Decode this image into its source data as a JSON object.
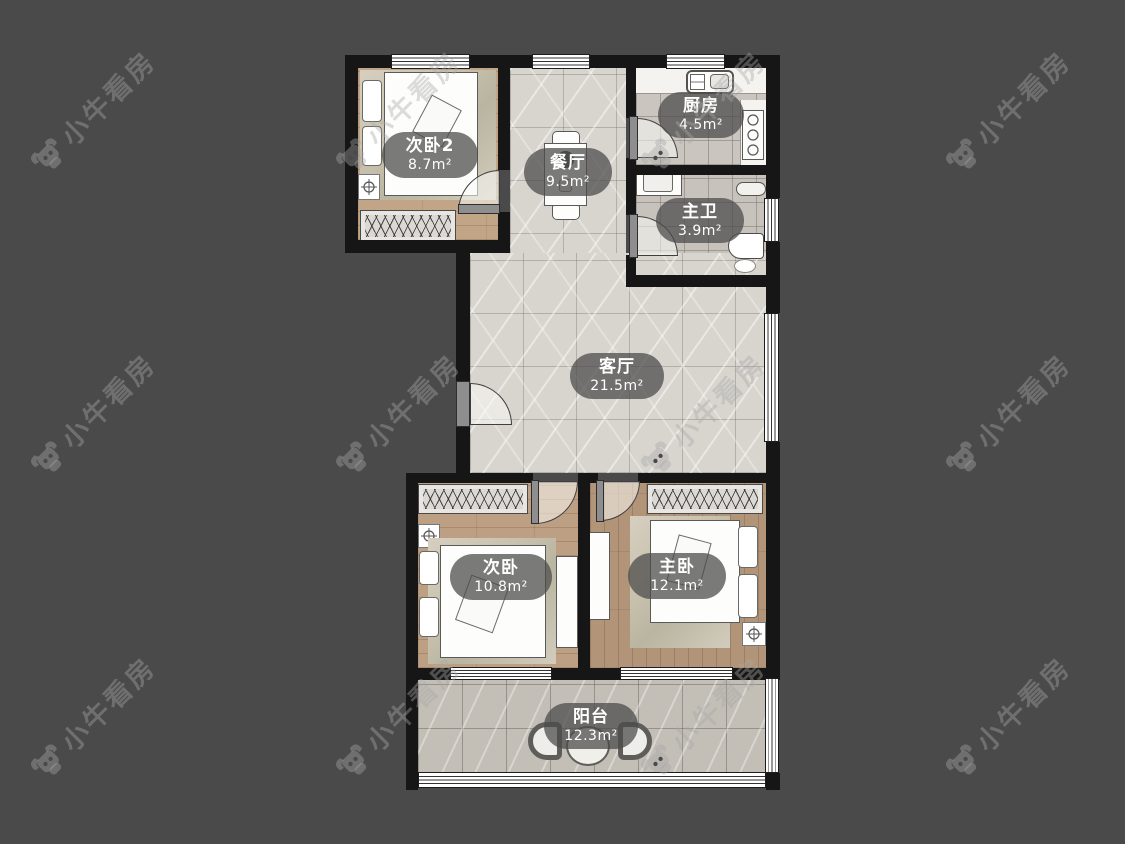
{
  "watermark": {
    "text": "小牛看房"
  },
  "rooms": {
    "bedroom2": {
      "name": "次卧2",
      "area": "8.7m²"
    },
    "dining": {
      "name": "餐厅",
      "area": "9.5m²"
    },
    "kitchen": {
      "name": "厨房",
      "area": "4.5m²"
    },
    "master_bath": {
      "name": "主卫",
      "area": "3.9m²"
    },
    "living": {
      "name": "客厅",
      "area": "21.5m²"
    },
    "bedroom": {
      "name": "次卧",
      "area": "10.8m²"
    },
    "master_bedroom": {
      "name": "主卧",
      "area": "12.1m²"
    },
    "balcony": {
      "name": "阳台",
      "area": "12.3m²"
    }
  },
  "colors": {
    "background": "#4a4a4b",
    "wall": "#161616",
    "marble_floor": "#d8d5cf",
    "wood_floor": "#bda083",
    "label_pill": "#5c5c5c",
    "label_text": "#ffffff"
  }
}
